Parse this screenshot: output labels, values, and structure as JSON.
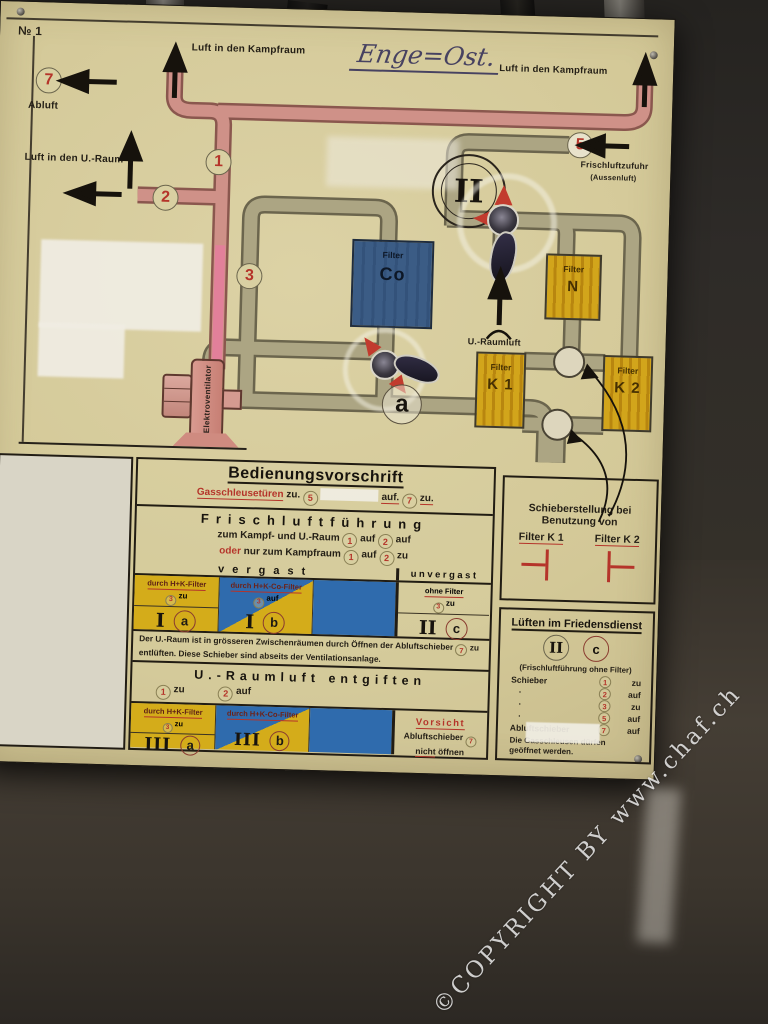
{
  "scene": {
    "watermark": "©COPYRIGHT BY www.chaf.ch"
  },
  "panel": {
    "plate_no": "№ 1",
    "handwritten": "Enge=Ost.",
    "labels": {
      "abluft": "Abluft",
      "kampfraum_left": "Luft in den Kampfraum",
      "kampfraum_right": "Luft in den Kampfraum",
      "uraum": "Luft in den U.-Raum",
      "frischluftzufuhr": "Frischluftzufuhr",
      "aussenluft": "(Aussenluft)",
      "uraumluft": "U.-Raumluft",
      "fan": "Elektroventilator"
    },
    "marks": {
      "n1": "1",
      "n2": "2",
      "n3": "3",
      "n5": "5",
      "n7": "7",
      "a": "a",
      "roman_II": "II"
    },
    "filters": {
      "co": {
        "top": "Filter",
        "main": "Co"
      },
      "n": {
        "top": "Filter",
        "main": "N"
      },
      "k1": {
        "top": "Filter",
        "main": "K 1"
      },
      "k2": {
        "top": "Filter",
        "main": "K 2"
      }
    }
  },
  "instructions": {
    "title": "Bedienungsvorschrift",
    "gas": {
      "label": "Gasschleusetüren",
      "t1": "zu.",
      "n1": "5",
      "t2": "auf.",
      "n2": "7",
      "t3": "zu."
    },
    "frischluft": {
      "heading": "Frischluftführung",
      "line1": {
        "pre": "zum Kampf- und U.-Raum",
        "n1": "1",
        "v1": "auf",
        "n2": "2",
        "v2": "auf"
      },
      "line2": {
        "oder": "oder",
        "pre": "nur zum Kampfraum",
        "n1": "1",
        "v1": "auf",
        "n2": "2",
        "v2": "zu"
      },
      "vergast": "vergast",
      "unvergast": "unvergast",
      "cols": [
        {
          "header": "durch H+K-Filter",
          "n": "3",
          "state": "zu",
          "roman": "I",
          "letter": "a"
        },
        {
          "header": "durch H+K-Co-Filter",
          "n": "3",
          "state": "auf",
          "roman": "I",
          "letter": "b"
        },
        {
          "header": "ohne Filter",
          "n": "3",
          "state": "zu",
          "roman": "II",
          "letter": "c"
        }
      ],
      "note_pre": "Der U.-Raum ist in grösseren Zwischenräumen durch Öffnen der Abluftschieber",
      "note_n": "7",
      "note_post": "zu entlüften. Diese Schieber sind abseits der Ventilationsanlage."
    },
    "entgiften": {
      "heading": "U.-Raumluft entgiften",
      "line": {
        "n1": "1",
        "v1": "zu",
        "n2": "2",
        "v2": "auf"
      },
      "cols": [
        {
          "header": "durch H+K-Filter",
          "n": "3",
          "state": "zu",
          "roman": "III",
          "letter": "a"
        },
        {
          "header": "durch H+K-Co-Filter",
          "roman": "III",
          "letter": "b"
        }
      ],
      "warning": {
        "title": "Vorsicht",
        "l1": "Abluftschieber",
        "n": "7",
        "l2a": "nicht",
        "l2b": "öffnen"
      }
    }
  },
  "side": {
    "schieber": {
      "line1": "Schieberstellung bei",
      "line2": "Benutzung von",
      "k1": "Filter K 1",
      "k2": "Filter K 2"
    },
    "frieden": {
      "title": "Lüften im Friedensdienst",
      "roman": "II",
      "letter": "c",
      "subtitle": "(Frischluftführung ohne Filter)",
      "rows": [
        {
          "label": "Schieber",
          "n": "1",
          "v": "zu"
        },
        {
          "label": "·",
          "n": "2",
          "v": "auf"
        },
        {
          "label": "·",
          "n": "3",
          "v": "zu"
        },
        {
          "label": "·",
          "n": "5",
          "v": "auf"
        },
        {
          "label": "Abluftschieber",
          "n": "7",
          "v": "auf"
        }
      ],
      "footer": "Die Gasschleusen dürfen geöffnet werden."
    }
  },
  "colors": {
    "panel_bg": "#d3c897",
    "pipe_pink": "#cf9188",
    "pipe_pink_bright": "#e2809a",
    "pipe_olive": "#aca583",
    "filter_yellow": "#d0a41e",
    "filter_blue": "#3b5c85",
    "table_blue": "#2f6bad",
    "accent_red": "#b5342a"
  }
}
